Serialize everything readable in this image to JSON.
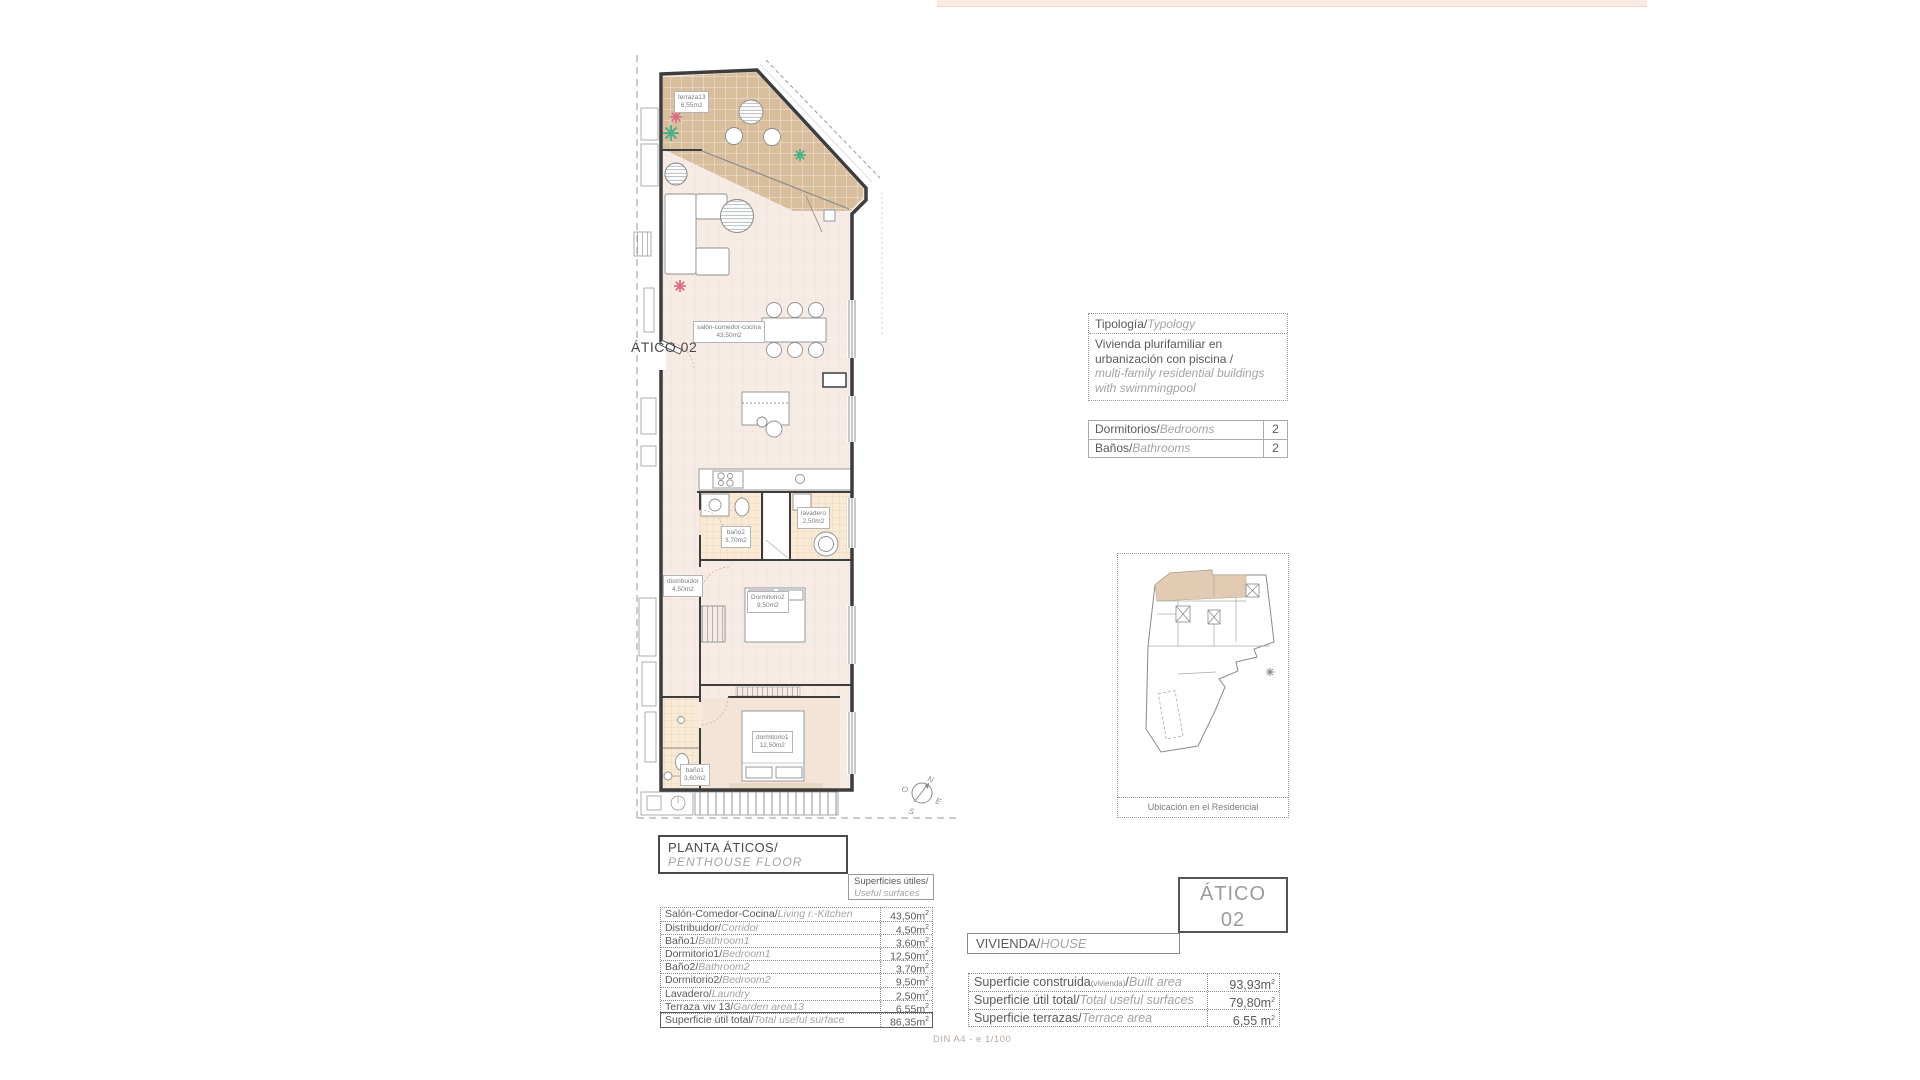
{
  "page": {
    "scale_note": "DIN A4 - e 1/100"
  },
  "plan": {
    "unit_label": "ÁTICO 02",
    "rooms": [
      {
        "name": "terraza13",
        "area": "6,55m2"
      },
      {
        "name": "salón-comedor-cocina",
        "area": "43,50m2"
      },
      {
        "name": "baño2",
        "area": "3,70m2"
      },
      {
        "name": "lavadero",
        "area": "2,50m2"
      },
      {
        "name": "distribuidor",
        "area": "4,50m2"
      },
      {
        "name": "Dormitorio2",
        "area": "9,50m2"
      },
      {
        "name": "dormitorio1",
        "area": "12,50m2"
      },
      {
        "name": "baño1",
        "area": "3,60m2"
      }
    ],
    "compass": {
      "n": "N",
      "o": "O",
      "e": "E",
      "s": "S"
    }
  },
  "typology": {
    "title_es": "Tipología/",
    "title_en": "Typology",
    "line1": "Vivienda plurifamiliar en",
    "line2": "urbanización con piscina  /",
    "line3": "multi-family residential buildings",
    "line4": "with swimmingpool"
  },
  "stats": {
    "rows": [
      {
        "es": "Dormitorios/",
        "en": "Bedrooms",
        "value": "2"
      },
      {
        "es": "Baños/",
        "en": "Bathrooms",
        "value": "2"
      }
    ]
  },
  "location": {
    "caption": "Ubicación en el Residencial"
  },
  "floor_title": {
    "es": "PLANTA ÁTICOS/",
    "en": "PENTHOUSE  FLOOR"
  },
  "useful_header": {
    "es": "Superficies útiles/",
    "en": "Useful surfaces"
  },
  "useful_table": {
    "rows": [
      {
        "es": "Salón-Comedor-Cocina/",
        "en": "Living r.-Kitchen",
        "value": "43,50m",
        "sup": "2"
      },
      {
        "es": "Distribuidor/",
        "en": "Corridor",
        "value": "4,50m",
        "sup": "2"
      },
      {
        "es": "Baño1/",
        "en": "Bathroom1",
        "value": "3,60m",
        "sup": "2"
      },
      {
        "es": "Dormitorio1/",
        "en": "Bedroom1",
        "value": "12,50m",
        "sup": "2"
      },
      {
        "es": "Baño2/",
        "en": "Bathroom2",
        "value": "3,70m",
        "sup": "2"
      },
      {
        "es": "Dormitorio2/",
        "en": "Bedroom2",
        "value": "9,50m",
        "sup": "2"
      },
      {
        "es": "Lavadero/",
        "en": "Laundry",
        "value": "2,50m",
        "sup": "2"
      },
      {
        "es": "Terraza viv 13/",
        "en": "Garden area13",
        "value": "6,55m",
        "sup": "2"
      }
    ],
    "total": {
      "es": "Superficie útil total/",
      "en": "Total useful surface",
      "value": "86,35m",
      "sup": "2"
    }
  },
  "atico_box": {
    "line1": "ÁTICO",
    "line2": "02"
  },
  "vivienda": {
    "header_es": "VIVIENDA/",
    "header_en": "HOUSE",
    "rows": [
      {
        "es": "Superficie construida",
        "sub": "(vivienda)",
        "slash": "/",
        "en": "Built area",
        "value": "93,93m",
        "sup": "2"
      },
      {
        "es": "Superficie útil total",
        "sub": "",
        "slash": "/",
        "en": "Total useful surfaces",
        "value": "79,80m",
        "sup": "2"
      },
      {
        "es": "Superficie terrazas",
        "sub": "",
        "slash": "/",
        "en": "Terrace area",
        "value": "6,55 m",
        "sup": "2"
      }
    ]
  },
  "colors": {
    "terrace": "#d9be9e",
    "floor": "#f7ebe6",
    "tile": "#f8ead7",
    "plant_pink": "#d96f82",
    "plant_green": "#4fae85"
  }
}
